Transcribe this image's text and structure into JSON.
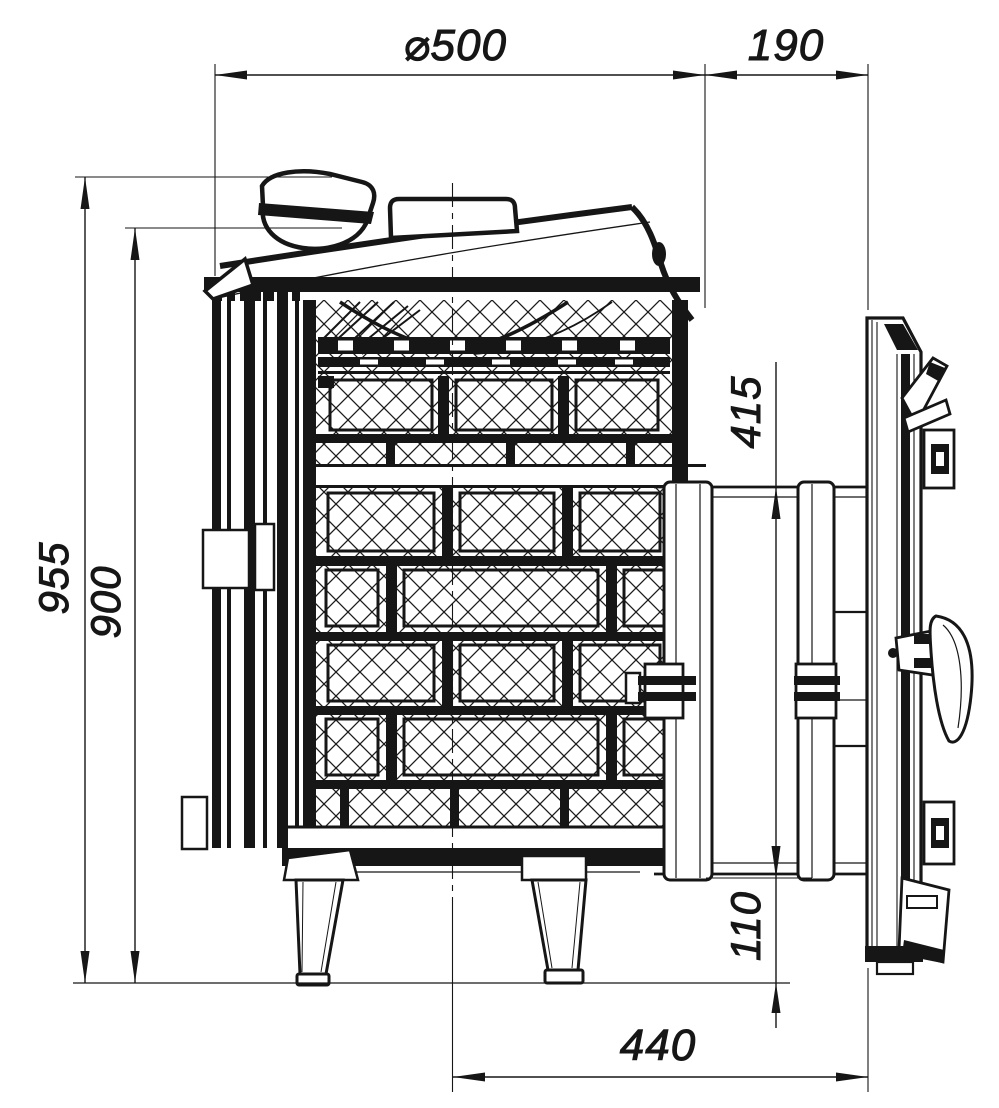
{
  "drawing": {
    "labels": {
      "d500": "⌀500",
      "d190": "190",
      "d955": "955",
      "d900": "900",
      "d415": "415",
      "d110": "110",
      "d440": "440"
    },
    "line_color": "#161616",
    "background": "#ffffff"
  }
}
